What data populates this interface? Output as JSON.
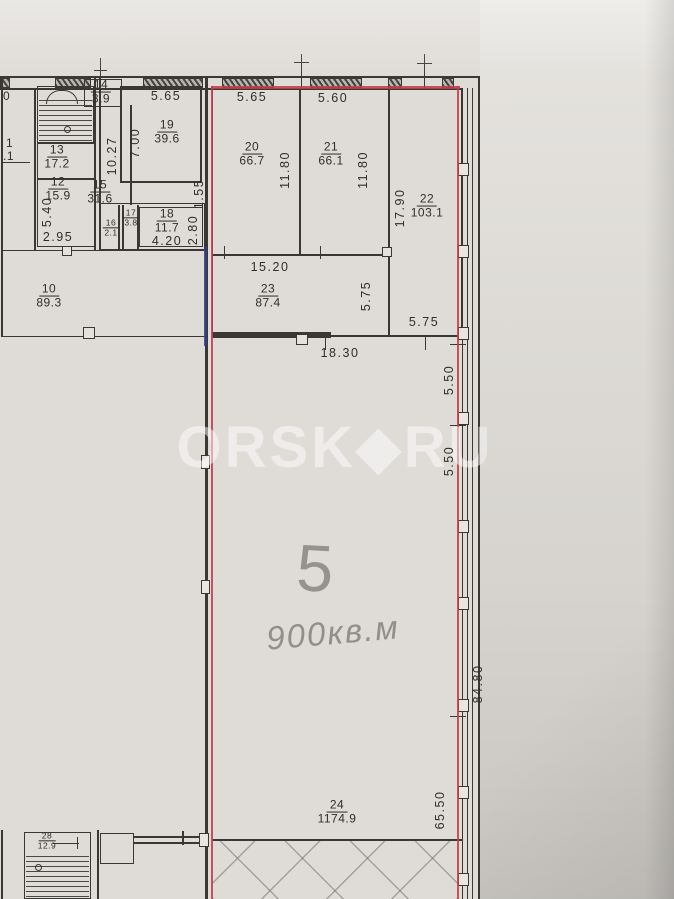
{
  "watermark": {
    "text": "ORSK◆RU"
  },
  "handwriting": {
    "number": "5",
    "area_text": "900кв.м"
  },
  "palette": {
    "paper": "#dfdcd7",
    "ink": "#3a3835",
    "red_marker": "#c13e49",
    "blue_marker": "#303e8d",
    "pencil": "#8a8781",
    "watermark": "#ffffff"
  },
  "rooms": [
    {
      "number": "13",
      "area": "17.2",
      "cx": 57,
      "cy": 157
    },
    {
      "number": "12",
      "area": "15.9",
      "cx": 58,
      "cy": 189
    },
    {
      "number": "14",
      "area": "3.9",
      "cx": 101,
      "cy": 92
    },
    {
      "number": "15",
      "area": "31.6",
      "cx": 100,
      "cy": 192
    },
    {
      "number": "19",
      "area": "39.6",
      "cx": 167,
      "cy": 132
    },
    {
      "number": "16",
      "area": "2.1",
      "cx": 111,
      "cy": 228,
      "small": true
    },
    {
      "number": "17",
      "area": "3.8",
      "cx": 131,
      "cy": 218,
      "small": true
    },
    {
      "number": "18",
      "area": "11.7",
      "cx": 167,
      "cy": 221
    },
    {
      "number": "10",
      "area": "89.3",
      "cx": 49,
      "cy": 296
    },
    {
      "number": "20",
      "area": "66.7",
      "cx": 252,
      "cy": 154
    },
    {
      "number": "21",
      "area": "66.1",
      "cx": 331,
      "cy": 154
    },
    {
      "number": "22",
      "area": "103.1",
      "cx": 427,
      "cy": 206
    },
    {
      "number": "23",
      "area": "87.4",
      "cx": 268,
      "cy": 296
    },
    {
      "number": "24",
      "area": "1174.9",
      "cx": 337,
      "cy": 812
    },
    {
      "number": "28",
      "area": "12.9",
      "cx": 47,
      "cy": 841,
      "small": true
    }
  ],
  "dimensions": [
    {
      "text": "5.65",
      "cx": 166,
      "cy": 96
    },
    {
      "text": "5.65",
      "cx": 252,
      "cy": 97
    },
    {
      "text": "5.60",
      "cx": 333,
      "cy": 98
    },
    {
      "text": "7.00",
      "cx": 135,
      "cy": 143,
      "vertical": true
    },
    {
      "text": "10.27",
      "cx": 112,
      "cy": 156,
      "vertical": true
    },
    {
      "text": "5.40",
      "cx": 47,
      "cy": 212,
      "vertical": true
    },
    {
      "text": "2.95",
      "cx": 58,
      "cy": 237
    },
    {
      "text": "1.55",
      "cx": 199,
      "cy": 194,
      "vertical": true
    },
    {
      "text": "4.20",
      "cx": 167,
      "cy": 241
    },
    {
      "text": "2.80",
      "cx": 193,
      "cy": 230,
      "vertical": true
    },
    {
      "text": "11.80",
      "cx": 285,
      "cy": 170,
      "vertical": true
    },
    {
      "text": "11.80",
      "cx": 363,
      "cy": 170,
      "vertical": true
    },
    {
      "text": "17.90",
      "cx": 400,
      "cy": 208,
      "vertical": true
    },
    {
      "text": "15.20",
      "cx": 270,
      "cy": 267
    },
    {
      "text": "5.75",
      "cx": 366,
      "cy": 296,
      "vertical": true
    },
    {
      "text": "5.75",
      "cx": 424,
      "cy": 322
    },
    {
      "text": "18.30",
      "cx": 340,
      "cy": 353
    },
    {
      "text": "5.50",
      "cx": 449,
      "cy": 380,
      "vertical": true
    },
    {
      "text": "5.50",
      "cx": 449,
      "cy": 461,
      "vertical": true
    },
    {
      "text": "84.80",
      "cx": 478,
      "cy": 684,
      "vertical": true
    },
    {
      "text": "65.50",
      "cx": 440,
      "cy": 810,
      "vertical": true
    }
  ],
  "edge_fragments": [
    {
      "text": "0",
      "cx": 3,
      "cy": 96
    },
    {
      "text": "1",
      "cx": 6,
      "cy": 143
    },
    {
      "text": ".1",
      "cx": 3,
      "cy": 156
    }
  ]
}
